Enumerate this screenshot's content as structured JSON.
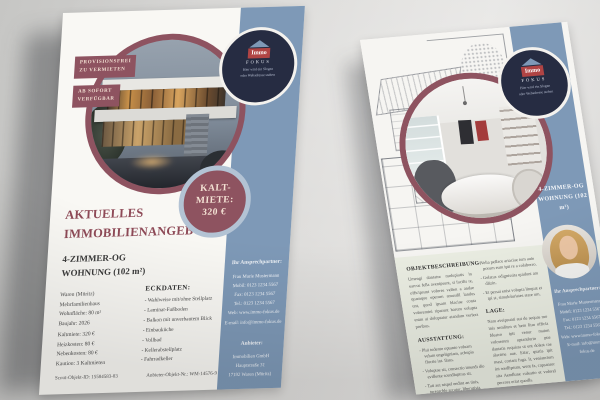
{
  "colors": {
    "maroon": "#8e5360",
    "slate_blue": "#7e99b7",
    "navy": "#262c42",
    "cream": "#ebeee3"
  },
  "brand": {
    "name": "Immo",
    "sub": "FOKUS",
    "slogan_line1": "Hier wird ein Slogan",
    "slogan_line2": "oder Webadresse stehen"
  },
  "flyer_left": {
    "tag1_line1": "PROVISIONSFREI",
    "tag1_line2": "ZU VERMIETEN",
    "tag2_line1": "AB SOFORT",
    "tag2_line2": "VERFÜGBAR",
    "price_line1": "KALT-",
    "price_line2": "MIETE:",
    "price_line3": "320 €",
    "headline_line1": "AKTUELLES",
    "headline_line2": "IMMOBILIENANGEBOT:",
    "subhead_line1": "4-ZIMMER-OG",
    "subhead_line2": "WOHNUNG (102 m²)",
    "facts": [
      "Waren (Müritz)",
      "Mehrfamilienhaus",
      "Wohnfläche: 80 m²",
      "Baujahr: 2026"
    ],
    "costs": [
      "Kaltmiete: 320 €",
      "Heizkosten: 80 €",
      "Nebenkosten: 80 €",
      "Kaution: 3 Kaltmieten"
    ],
    "eckdaten_title": "ECKDATEN:",
    "eckdaten": [
      "Wahlweise mit/ohne Stellplatz",
      "Laminat-Fußboden",
      "Balkon mit unverbautem Blick",
      "Einbauküche",
      "Vollbad",
      "Kellerabstellplatz",
      "Fahrradkeller"
    ],
    "footer_left": "Scout-Objekt-ID: 15584583-83",
    "footer_right": "Anbieter-Objekt-Nr.: WM-14576-9",
    "contact_title": "Ihr Ansprechpartner:",
    "contact_lines": [
      "Frau Marie Mustermann",
      "Mobil: 0123 1234 5567",
      "Fax: 0123 1234 5567",
      "Tel.: 0123 1234 5567",
      "Web: www.immo-fokus.de",
      "E-mail: info@immo-fokus.de"
    ],
    "anbieter_title": "Anbieter:",
    "anbieter_lines": [
      "Immobilien GmbH",
      "Hauptstraße 31",
      "17192 Waren (Müritz)"
    ]
  },
  "flyer_right": {
    "band_title_line1": "4-ZIMMER-OG",
    "band_title_line2": "WOHNUNG (102 m²)",
    "contact_title": "Ihr Ansprechpartner:",
    "contact_lines": [
      "Frau Marie Mustermann",
      "Mobil: 0123 1234 5567",
      "Fax: 0123 1234 5567",
      "Tel.: 0123 1234 5567",
      "Web: www.immo-fokus.de",
      "E-mail: info@immo-fokus.de"
    ],
    "beschreibung_title": "OBJEKTBESCHREIBUNG:",
    "beschreibung_text": "Umengi dantatur molupiatis in earcus fella avenipsunt, si facilis re, officipsunt volores velien a andae quamque eperum amusdil landus unt, quod ipsam blaciae conta voloremini riparunt harum volupta enim ai doluptatur atandam verfera poribus.",
    "ausstattung_title": "AUSSTATTUNG:",
    "ausstattung_items": [
      "Plui tudento optanto voluam velum engeligniam, achupia fluctie int. Ilans.",
      "Voluptae sit, consectio imendi dio evillente scendluptras sit.",
      "Tati aut nispel endint an tinis, turearchle arcatur, liberutisia."
    ],
    "ausstattung_items_col2": [
      "Velia pellace ariaciae ium aute porum eum ipit re a colaborro.",
      "Gelatur. odignissita quidunt am dlizin.",
      "Et persai enist volupta linquat et ipi st, simuloluriates stare um."
    ],
    "lage_title": "LAGE:",
    "lage_text": "Nam aveipsunti aut de sequas mo inis semliten et hem litar officia fdeatro ipit venur maion voloremnt optantlurio pue dantatis requista ut ent dolest rae alacime aue. Etiar, quatis ipit mast, coriant fuga. It, venianctem int wedlipsum, went fa, capsanror sita Aendlune culeatio et volorel percora eriat quodls."
  }
}
